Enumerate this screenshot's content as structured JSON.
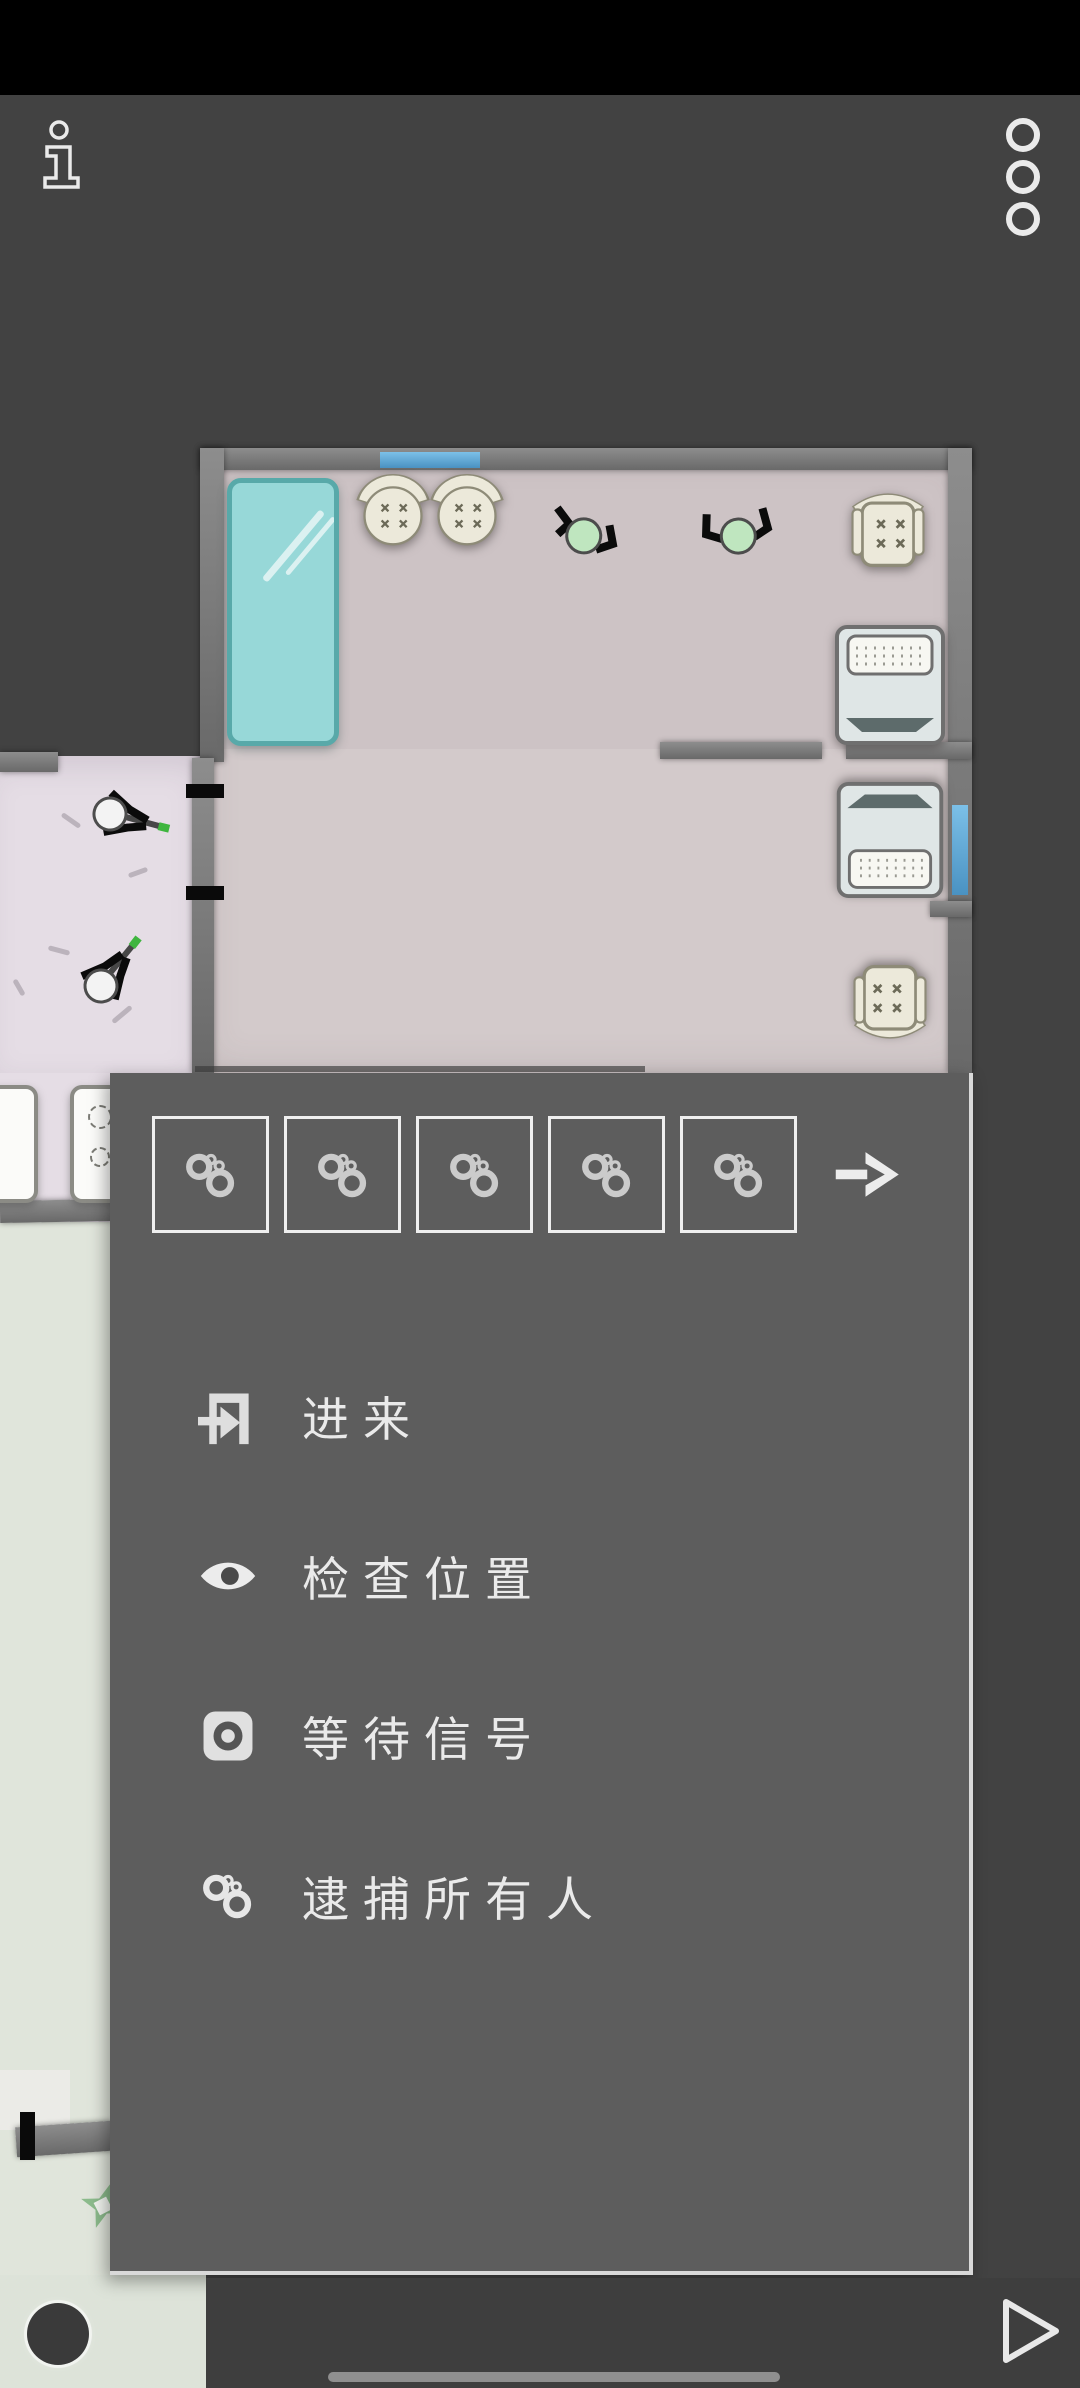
{
  "app": {
    "name": "tactical-floorplan-game"
  },
  "top_bar": {
    "info_icon": "info-icon",
    "overflow_icon": "three-dots-menu-icon"
  },
  "command_menu": {
    "loadout_buttons": [
      {
        "icon": "handcuffs-icon"
      },
      {
        "icon": "handcuffs-icon"
      },
      {
        "icon": "handcuffs-icon"
      },
      {
        "icon": "handcuffs-icon"
      },
      {
        "icon": "handcuffs-icon"
      }
    ],
    "more_button_icon": "arrow-right-icon",
    "items": [
      {
        "icon": "door-enter-icon",
        "label": "进来"
      },
      {
        "icon": "eye-icon",
        "label": "检查位置"
      },
      {
        "icon": "wait-signal-icon",
        "label": "等待信号"
      },
      {
        "icon": "handcuffs-icon",
        "label": "逮捕所有人"
      }
    ]
  },
  "map": {
    "characters": [
      {
        "type": "civilian",
        "color": "#bfe6bf"
      },
      {
        "type": "civilian",
        "color": "#bfe6bf"
      },
      {
        "type": "suspect-armed",
        "color": "#f3f3f3"
      },
      {
        "type": "suspect-armed",
        "color": "#f3f3f3"
      }
    ],
    "window_color": "#4f9bc8",
    "floor_colors": {
      "pink": "#d0c6c7",
      "lavender": "#e5dde5",
      "sage": "#dfe4da"
    }
  },
  "bottom_bar": {
    "play_icon": "play-icon",
    "cancel_icon": "dark-circle-button",
    "home_indicator": "home-indicator"
  },
  "colors": {
    "panel": "#5d5d5d",
    "background": "#424242",
    "status_bar": "#000000",
    "accent_light": "#ececec"
  }
}
